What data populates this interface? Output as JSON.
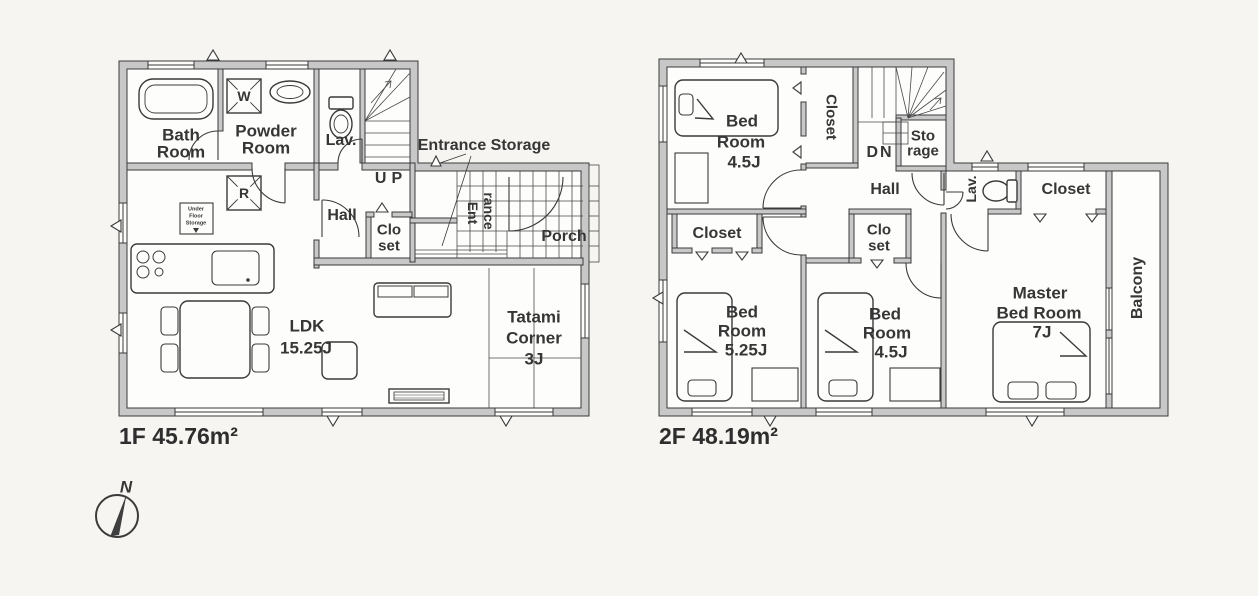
{
  "colors": {
    "wall_fill": "#c8c8c8",
    "line": "#3a3a3a",
    "paper": "#f6f5f1"
  },
  "compass": {
    "north": "N"
  },
  "floor1": {
    "title": "1F 45.76m²",
    "bath": [
      "Bath",
      "Room"
    ],
    "powder": [
      "Powder",
      "Room"
    ],
    "lav": "Lav.",
    "up": "UP",
    "hall": "Hall",
    "closet": [
      "Clo",
      "set"
    ],
    "entrance_storage": "Entrance Storage",
    "entrance": [
      "Ent",
      "rance"
    ],
    "porch": "Porch",
    "ldk": [
      "LDK",
      "15.25J"
    ],
    "tatami": [
      "Tatami",
      "Corner",
      "3J"
    ],
    "washer": "W",
    "fridge": "R",
    "underfloor": [
      "Under",
      "Floor",
      "Storage"
    ]
  },
  "floor2": {
    "title": "2F 48.19m²",
    "bedroom1": [
      "Bed",
      "Room",
      "4.5J"
    ],
    "closet_top": "Closet",
    "down": "DN",
    "storage": [
      "Sto",
      "rage"
    ],
    "hall": "Hall",
    "lav": "Lav.",
    "closet_master": "Closet",
    "closet_left": "Closet",
    "closet_mid": [
      "Clo",
      "set"
    ],
    "bedroom2": [
      "Bed",
      "Room",
      "5.25J"
    ],
    "bedroom3": [
      "Bed",
      "Room",
      "4.5J"
    ],
    "master": [
      "Master",
      "Bed Room",
      "7J"
    ],
    "balcony": "Balcony"
  }
}
